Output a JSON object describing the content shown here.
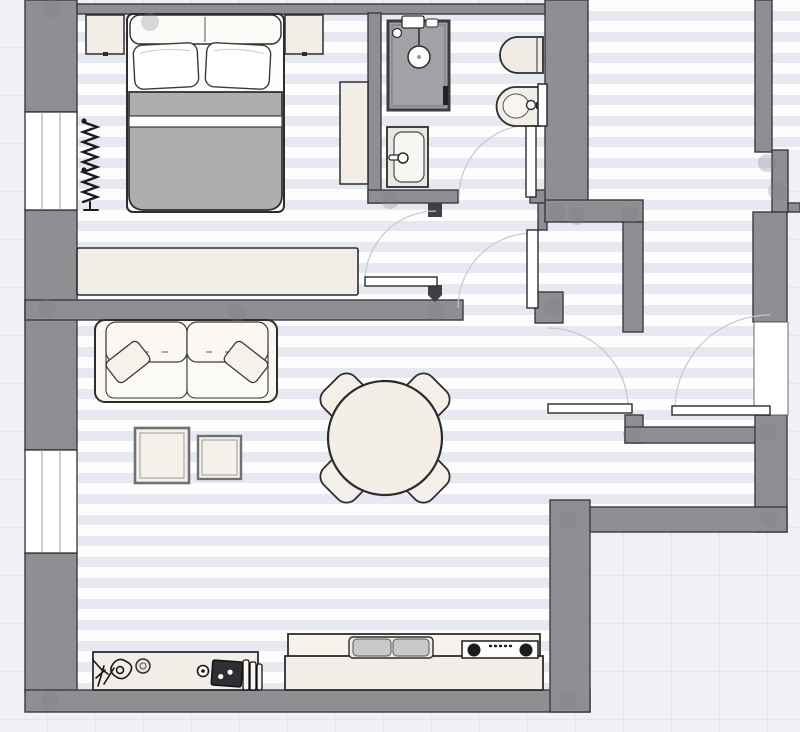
{
  "app": {
    "title": "apartment-floor-plan"
  },
  "colors": {
    "wall": "#8e8e93",
    "wall_outline": "#3b3b3f",
    "wall_wedge": "#3f3f44",
    "floor_base": "#fdfdfe",
    "floor_stripe": "#e7e9f1",
    "outside": "#f0f1f6",
    "outside_grid": "#e3e6ee",
    "furniture_cream": "#f2eee7",
    "furniture_white": "#fbf9f5",
    "blanket_gray": "#aeaeb1",
    "shower_tray": "#a2a2a6",
    "appliance_dark": "#1c1c1c",
    "door_leaf": "#ffffff",
    "door_arc": "#c7c7cd",
    "outline_dark": "#2d2d30"
  },
  "rooms": [
    {
      "name": "bedroom"
    },
    {
      "name": "bathroom"
    },
    {
      "name": "inner-hallway"
    },
    {
      "name": "corridor"
    },
    {
      "name": "entry-vestibule"
    },
    {
      "name": "living-dining-room"
    }
  ],
  "windows": [
    {
      "name": "bedroom-window-left-wall"
    },
    {
      "name": "living-room-window-left-wall"
    }
  ],
  "doors": [
    {
      "name": "bedroom-door"
    },
    {
      "name": "bathroom-door"
    },
    {
      "name": "hallway-door"
    },
    {
      "name": "vestibule-door"
    },
    {
      "name": "corridor-door"
    }
  ],
  "furniture": {
    "bedroom": [
      "double-bed",
      "pillow-left",
      "pillow-right",
      "nightstand-left",
      "nightstand-right",
      "wardrobe",
      "radiator",
      "sideboard-dresser"
    ],
    "bathroom": [
      "shower",
      "washbasin",
      "toilet",
      "bidet"
    ],
    "living_room": [
      "sofa",
      "throw-pillow-left",
      "throw-pillow-right",
      "coffee-table-large",
      "coffee-table-small",
      "dining-table-round",
      "dining-chair-nw",
      "dining-chair-ne",
      "dining-chair-sw",
      "dining-chair-se"
    ],
    "kitchen": [
      "console-island",
      "potted-plant",
      "decor-bowl",
      "decor-tray",
      "cutting-boards",
      "kitchen-counter",
      "double-sink",
      "cooktop"
    ]
  }
}
